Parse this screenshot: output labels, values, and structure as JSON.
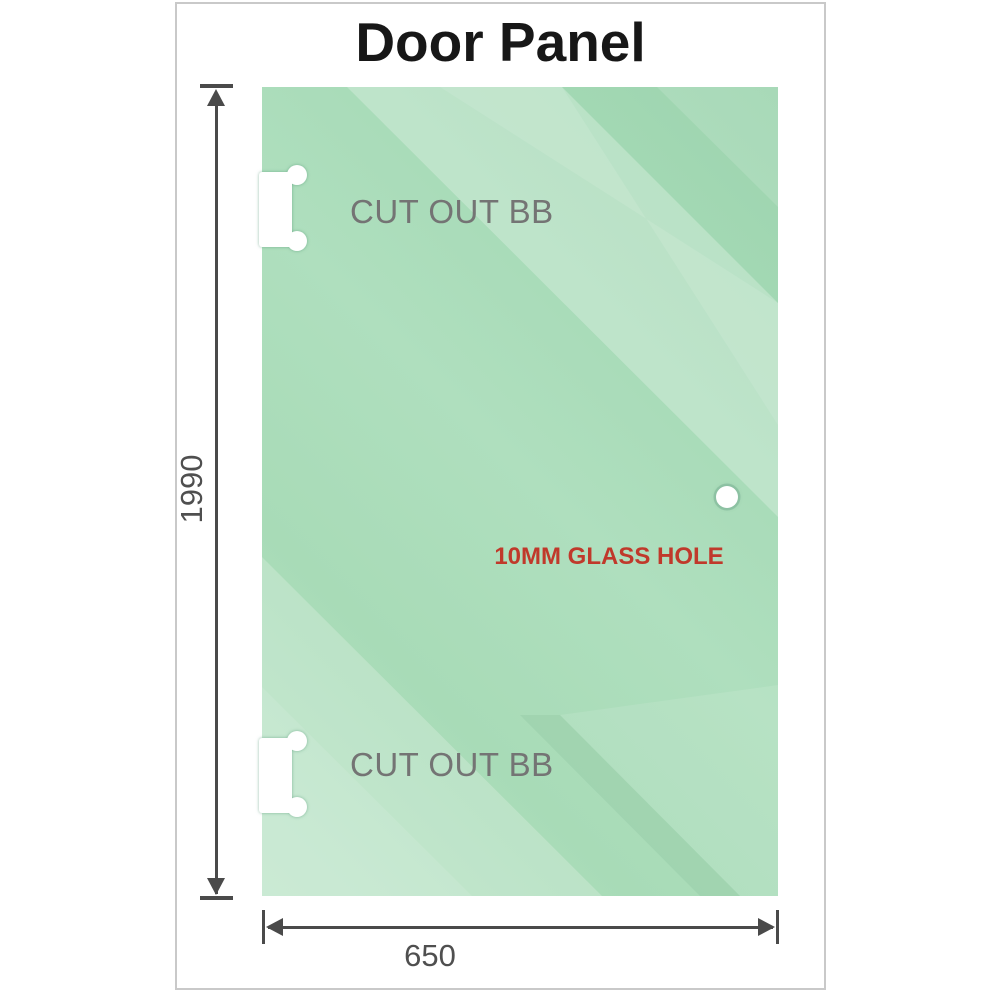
{
  "title": "Door Panel",
  "dimensions": {
    "height": "1990",
    "width": "650"
  },
  "cutouts": [
    {
      "label": "CUT OUT BB"
    },
    {
      "label": "CUT OUT BB"
    }
  ],
  "hole": {
    "label": "10MM GLASS HOLE"
  },
  "colors": {
    "glass_green_base": "#a8dbb7",
    "glass_green_dark": "#9cd4ae",
    "glass_green_light": "#c3e9cf",
    "dimension_line": "#4a4a4a",
    "cutout_label": "#747474",
    "hole_label": "#c0392b",
    "frame_border": "#c9c9c9",
    "title_text": "#171717"
  }
}
